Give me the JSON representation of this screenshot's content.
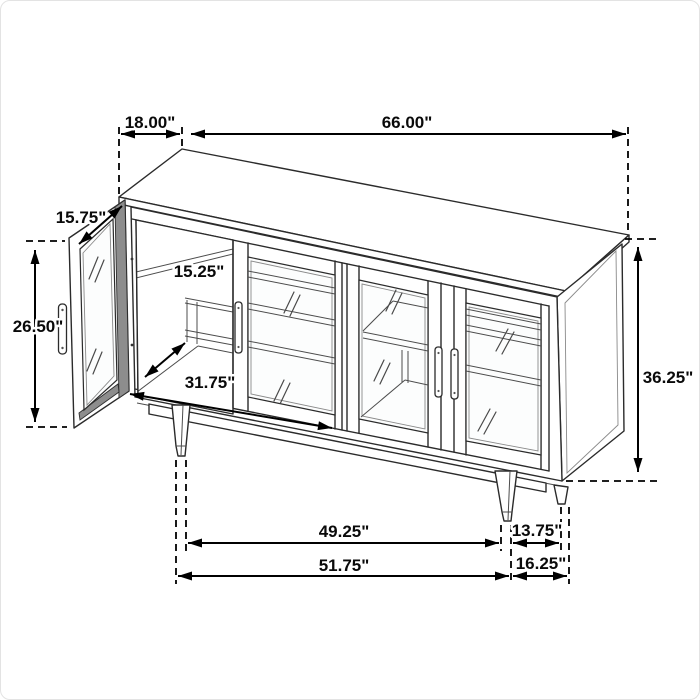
{
  "figure": {
    "type": "furniture-dimension-diagram",
    "subject": "4-door glass sideboard with open left door and tapered legs",
    "units": "inches"
  },
  "dimensions": {
    "top_depth": "18.00\"",
    "overall_width": "66.00\"",
    "door_width": "15.75\"",
    "door_opening_height": "26.50\"",
    "shelf_depth": "15.25\"",
    "interior_width": "31.75\"",
    "overall_height": "36.25\"",
    "leg_span_front_inner": "49.25\"",
    "leg_span_side_inner": "13.75\"",
    "leg_span_front_outer": "51.75\"",
    "leg_span_side_outer": "16.25\""
  },
  "style": {
    "dimension_color": "#000000",
    "drawing_color": "#2b2b2b",
    "background": "#ffffff"
  }
}
